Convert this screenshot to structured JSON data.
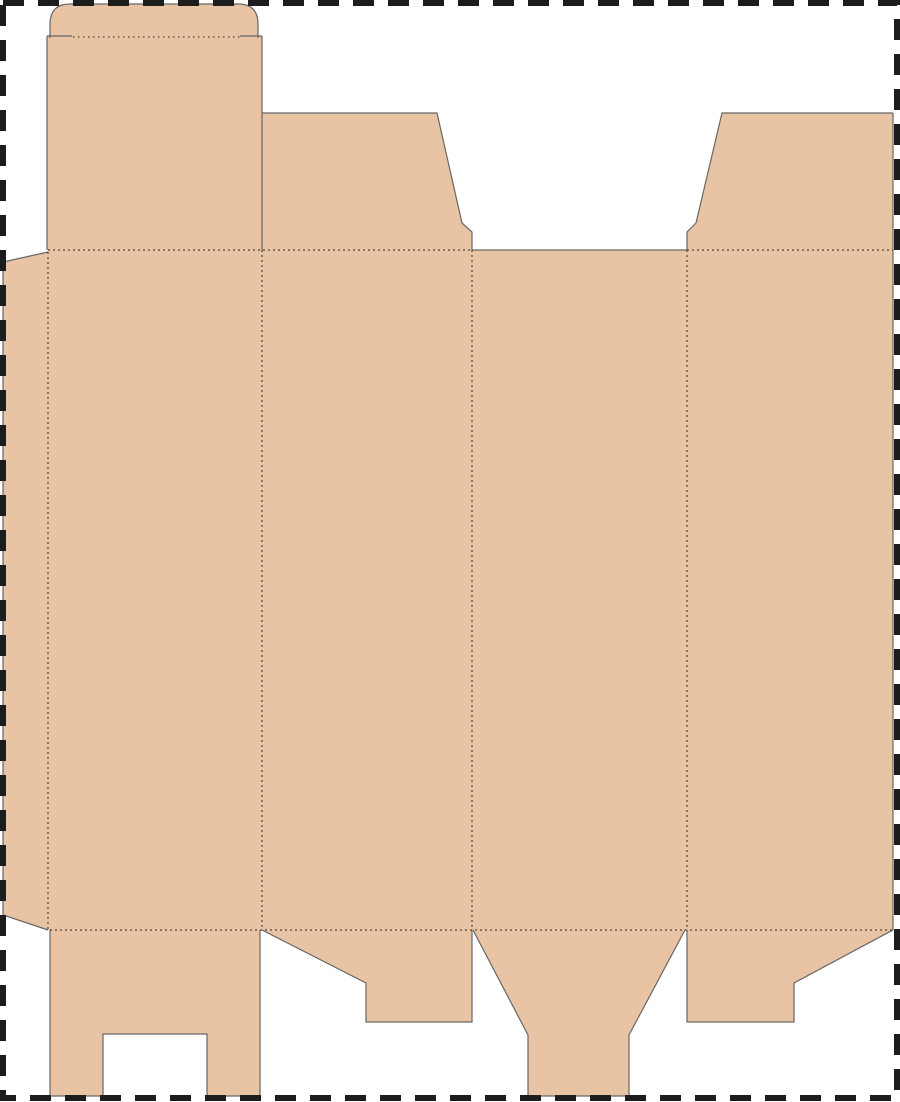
{
  "canvas": {
    "width": 900,
    "height": 1102
  },
  "colors": {
    "background": "#ffffff",
    "board": "#e8c4a4",
    "cut": "#666666",
    "fold": "#4d4439",
    "trim": "#1d1d1d"
  },
  "dieline": {
    "cut_width": 1.2,
    "fold_width": 1.2,
    "fills": [
      {
        "name": "tuck-flap-fill",
        "d": "M50,38 V24 Q50,4 70,4 H238 Q258,4 258,24 V38 Z"
      },
      {
        "name": "lid-panel-fill",
        "d": "M47,36 H262 V250 H47 Z"
      },
      {
        "name": "dust-flap-left-fill",
        "d": "M262,113 H437 L462,223 L472,232 V250 H262 Z"
      },
      {
        "name": "dust-flap-right-fill",
        "d": "M722,113 H893 V250 H687 V232 L696,223 Z"
      },
      {
        "name": "glue-flap-fill",
        "d": "M48,252 L3,262 V915 L48,930 Z"
      },
      {
        "name": "main-body-fill",
        "d": "M48,250 H893 V930 H48 Z"
      },
      {
        "name": "bottom-flap-1-fill",
        "d": "M50,930 H260 V1096 H207 V1034 H103 V1096 H50 Z"
      },
      {
        "name": "bottom-flap-2-fill",
        "d": "M262,930 H472 V1022 H366 V983 Z"
      },
      {
        "name": "bottom-tuck-flap-fill",
        "d": "M473,930 H685 L629,1035 V1096 H528 V1035 Z"
      },
      {
        "name": "bottom-flap-4-fill",
        "d": "M687,930 H893 L794,983 V1022 H687 Z"
      }
    ],
    "cuts": [
      {
        "name": "tuck-flap-outline",
        "d": "M50,38 V24 Q50,4 70,4 H238 Q258,4 258,24 V38"
      },
      {
        "name": "tuck-shoulder-slit-left",
        "d": "M47,36 H72"
      },
      {
        "name": "tuck-shoulder-slit-right",
        "d": "M240,36 H262"
      },
      {
        "name": "lid-left-edge",
        "d": "M47,36 V250"
      },
      {
        "name": "lid-right-edge",
        "d": "M262,36 V250"
      },
      {
        "name": "dust-flap-left-outline",
        "d": "M262,113 H437 L462,223 L472,232 V250"
      },
      {
        "name": "dust-flap-right-outline",
        "d": "M893,113 H722 L696,223 L687,232 V250"
      },
      {
        "name": "top-opening-edge",
        "d": "M472,250 H687"
      },
      {
        "name": "body-right-edge",
        "d": "M893,113 V930"
      },
      {
        "name": "glue-flap-outline",
        "d": "M48,252 L3,262 V915 L48,930"
      },
      {
        "name": "bottom-flap-1-outline",
        "d": "M50,930 V1096 H103 V1034 H207 V1096 H260 V930"
      },
      {
        "name": "bottom-flap-2-outline",
        "d": "M262,930 L366,983 V1022 H472 V930"
      },
      {
        "name": "bottom-tuck-outline",
        "d": "M473,930 L528,1035 V1096 H629 V1035 L685,930"
      },
      {
        "name": "bottom-flap-4-outline",
        "d": "M687,930 V1022 H794 V983 L893,930"
      }
    ],
    "folds": [
      {
        "name": "tuck-crease",
        "d": "M73,37 H240",
        "dash": "1.5 3.5"
      },
      {
        "name": "top-fold-left",
        "d": "M48,250 H472",
        "dash": "2 3"
      },
      {
        "name": "top-fold-right",
        "d": "M687,250 H893",
        "dash": "2 3"
      },
      {
        "name": "bottom-fold",
        "d": "M50,930 H893",
        "dash": "2 3"
      },
      {
        "name": "glue-flap-fold",
        "d": "M48,252 V930",
        "dash": "2 3"
      },
      {
        "name": "panel-fold-1",
        "d": "M262,250 V930",
        "dash": "2 3"
      },
      {
        "name": "panel-fold-2",
        "d": "M472,250 V930",
        "dash": "2 3"
      },
      {
        "name": "panel-fold-3",
        "d": "M687,250 V930",
        "dash": "2 3"
      }
    ],
    "trim_border": {
      "x": 3,
      "y": 3,
      "width": 894,
      "height": 1095,
      "dash": "21 14",
      "stroke_width": 6
    }
  }
}
